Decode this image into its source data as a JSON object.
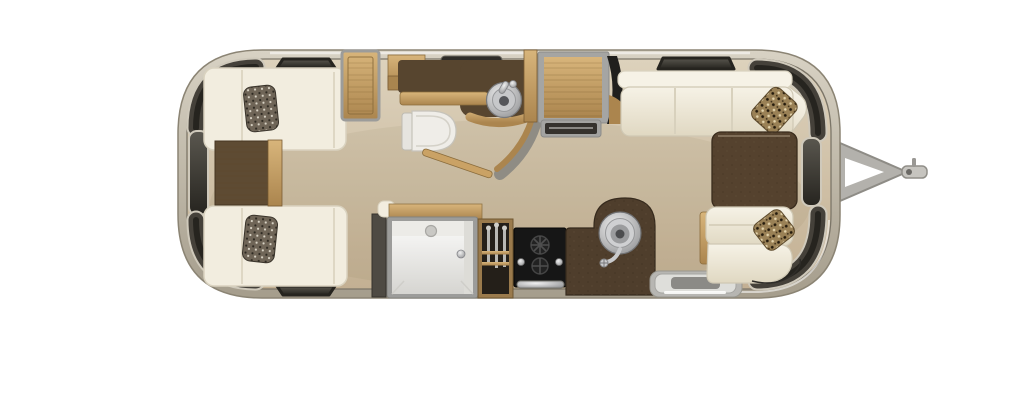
{
  "scene": {
    "kind": "floor-plan",
    "subject": "travel-trailer-top-view",
    "areas": [
      "rear-twin-bedroom",
      "bathroom",
      "galley-kitchen",
      "front-lounge",
      "entry",
      "hitch"
    ],
    "furniture": [
      "twin-bed-top",
      "twin-bed-bottom",
      "bed-pillow-top",
      "bed-pillow-bottom",
      "nightstand",
      "wardrobe",
      "bathroom-vanity",
      "vessel-sink",
      "faucet",
      "toilet",
      "bath-vent",
      "bath-partition-wall",
      "bathroom-door",
      "shower-stall",
      "pantry-cabinet",
      "cooktop-oven",
      "kitchen-sink-peninsula",
      "kitchen-sink",
      "entry-step",
      "refrigerator-cabinet",
      "lounge-sofa-top",
      "lounge-sofa-bottom",
      "lounge-pillow-top",
      "lounge-pillow-bottom",
      "coffee-table",
      "panoramic-window-rear",
      "panoramic-window-front",
      "hitch-a-frame",
      "hitch-coupler"
    ]
  },
  "colors": {
    "shell_light": "#d8d2c4",
    "shell_dark": "#a59d8c",
    "shell_edge": "#8b8474",
    "wall_line": "#7b7568",
    "floor_light": "#ddd2bc",
    "floor_dark": "#c3b093",
    "wood_light": "#d8b57b",
    "wood_dark": "#ab854e",
    "wood_frame": "#8a6c3c",
    "cabinet_brown": "#57452f",
    "counter_brown": "#4f3e2c",
    "table_brown": "#55422e",
    "nightstand_brown": "#5e4b33",
    "window_light": "#5a574f",
    "window_dark": "#26241f",
    "window_band": "#45413a",
    "sofa_light": "#f6f2e6",
    "sofa_dark": "#e0d8c2",
    "mattress": "#f2eddf",
    "steel_light": "#f0f0f0",
    "steel_dark": "#8f9092",
    "appliance_black": "#161616",
    "fixture_white": "#efede8",
    "pillow_bed": "#6f6557",
    "pillow_lounge": "#9a8156",
    "step_gray": "#dededa",
    "hitch_gray": "#b3b1ac",
    "frame_gray": "#9c9c9a",
    "shower_white": "#fbfbfa"
  }
}
